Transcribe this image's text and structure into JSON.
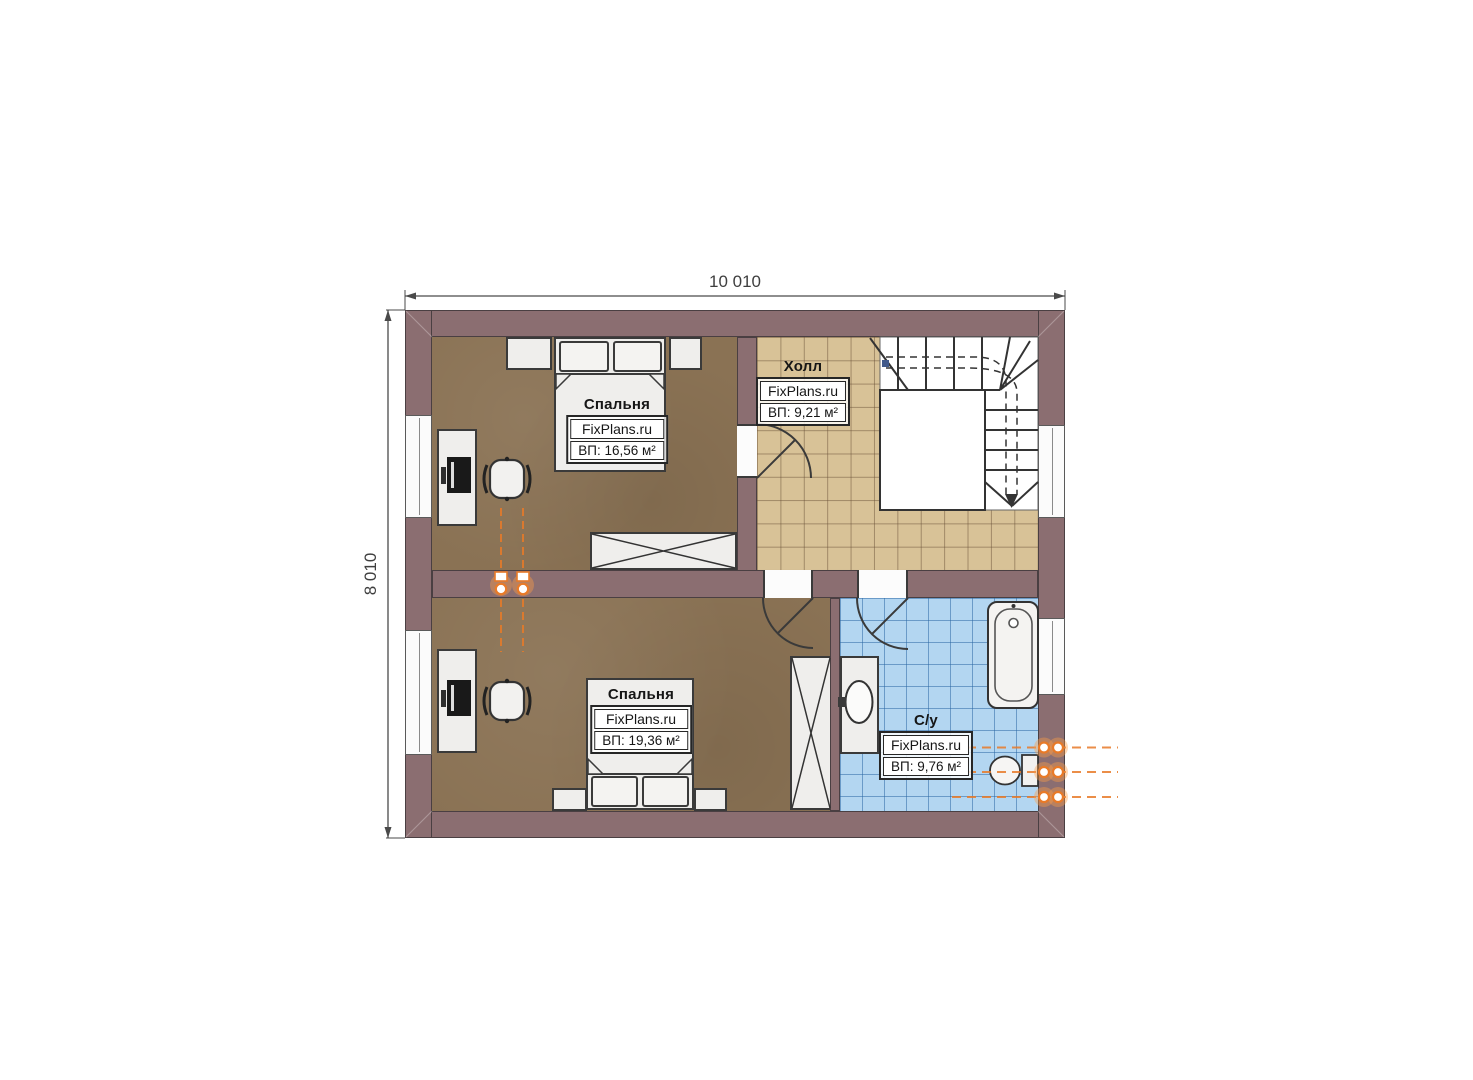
{
  "plan": {
    "type": "floor-plan-second-storey",
    "top_dimension": "10 010",
    "left_dimension": "8 010"
  },
  "rooms": {
    "bedroom_top": {
      "name": "Спальня",
      "brand": "FixPlans.ru",
      "area": "ВП: 16,56 м²"
    },
    "hall": {
      "name": "Холл",
      "brand": "FixPlans.ru",
      "area": "ВП: 9,21 м²"
    },
    "bedroom_bottom": {
      "name": "Спальня",
      "brand": "FixPlans.ru",
      "area": "ВП: 19,36 м²"
    },
    "bathroom": {
      "name": "С/у",
      "brand": "FixPlans.ru",
      "area": "ВП: 9,76 м²"
    }
  },
  "colors": {
    "wall": "#8b6e71",
    "bedroom_floor": "#8a7254",
    "hall_tile": "#d8c297",
    "bathroom_tile": "#b3d6f1",
    "pipe_accent": "#e87a28",
    "furniture": "#efeeec",
    "outline": "#3a3a3a"
  }
}
